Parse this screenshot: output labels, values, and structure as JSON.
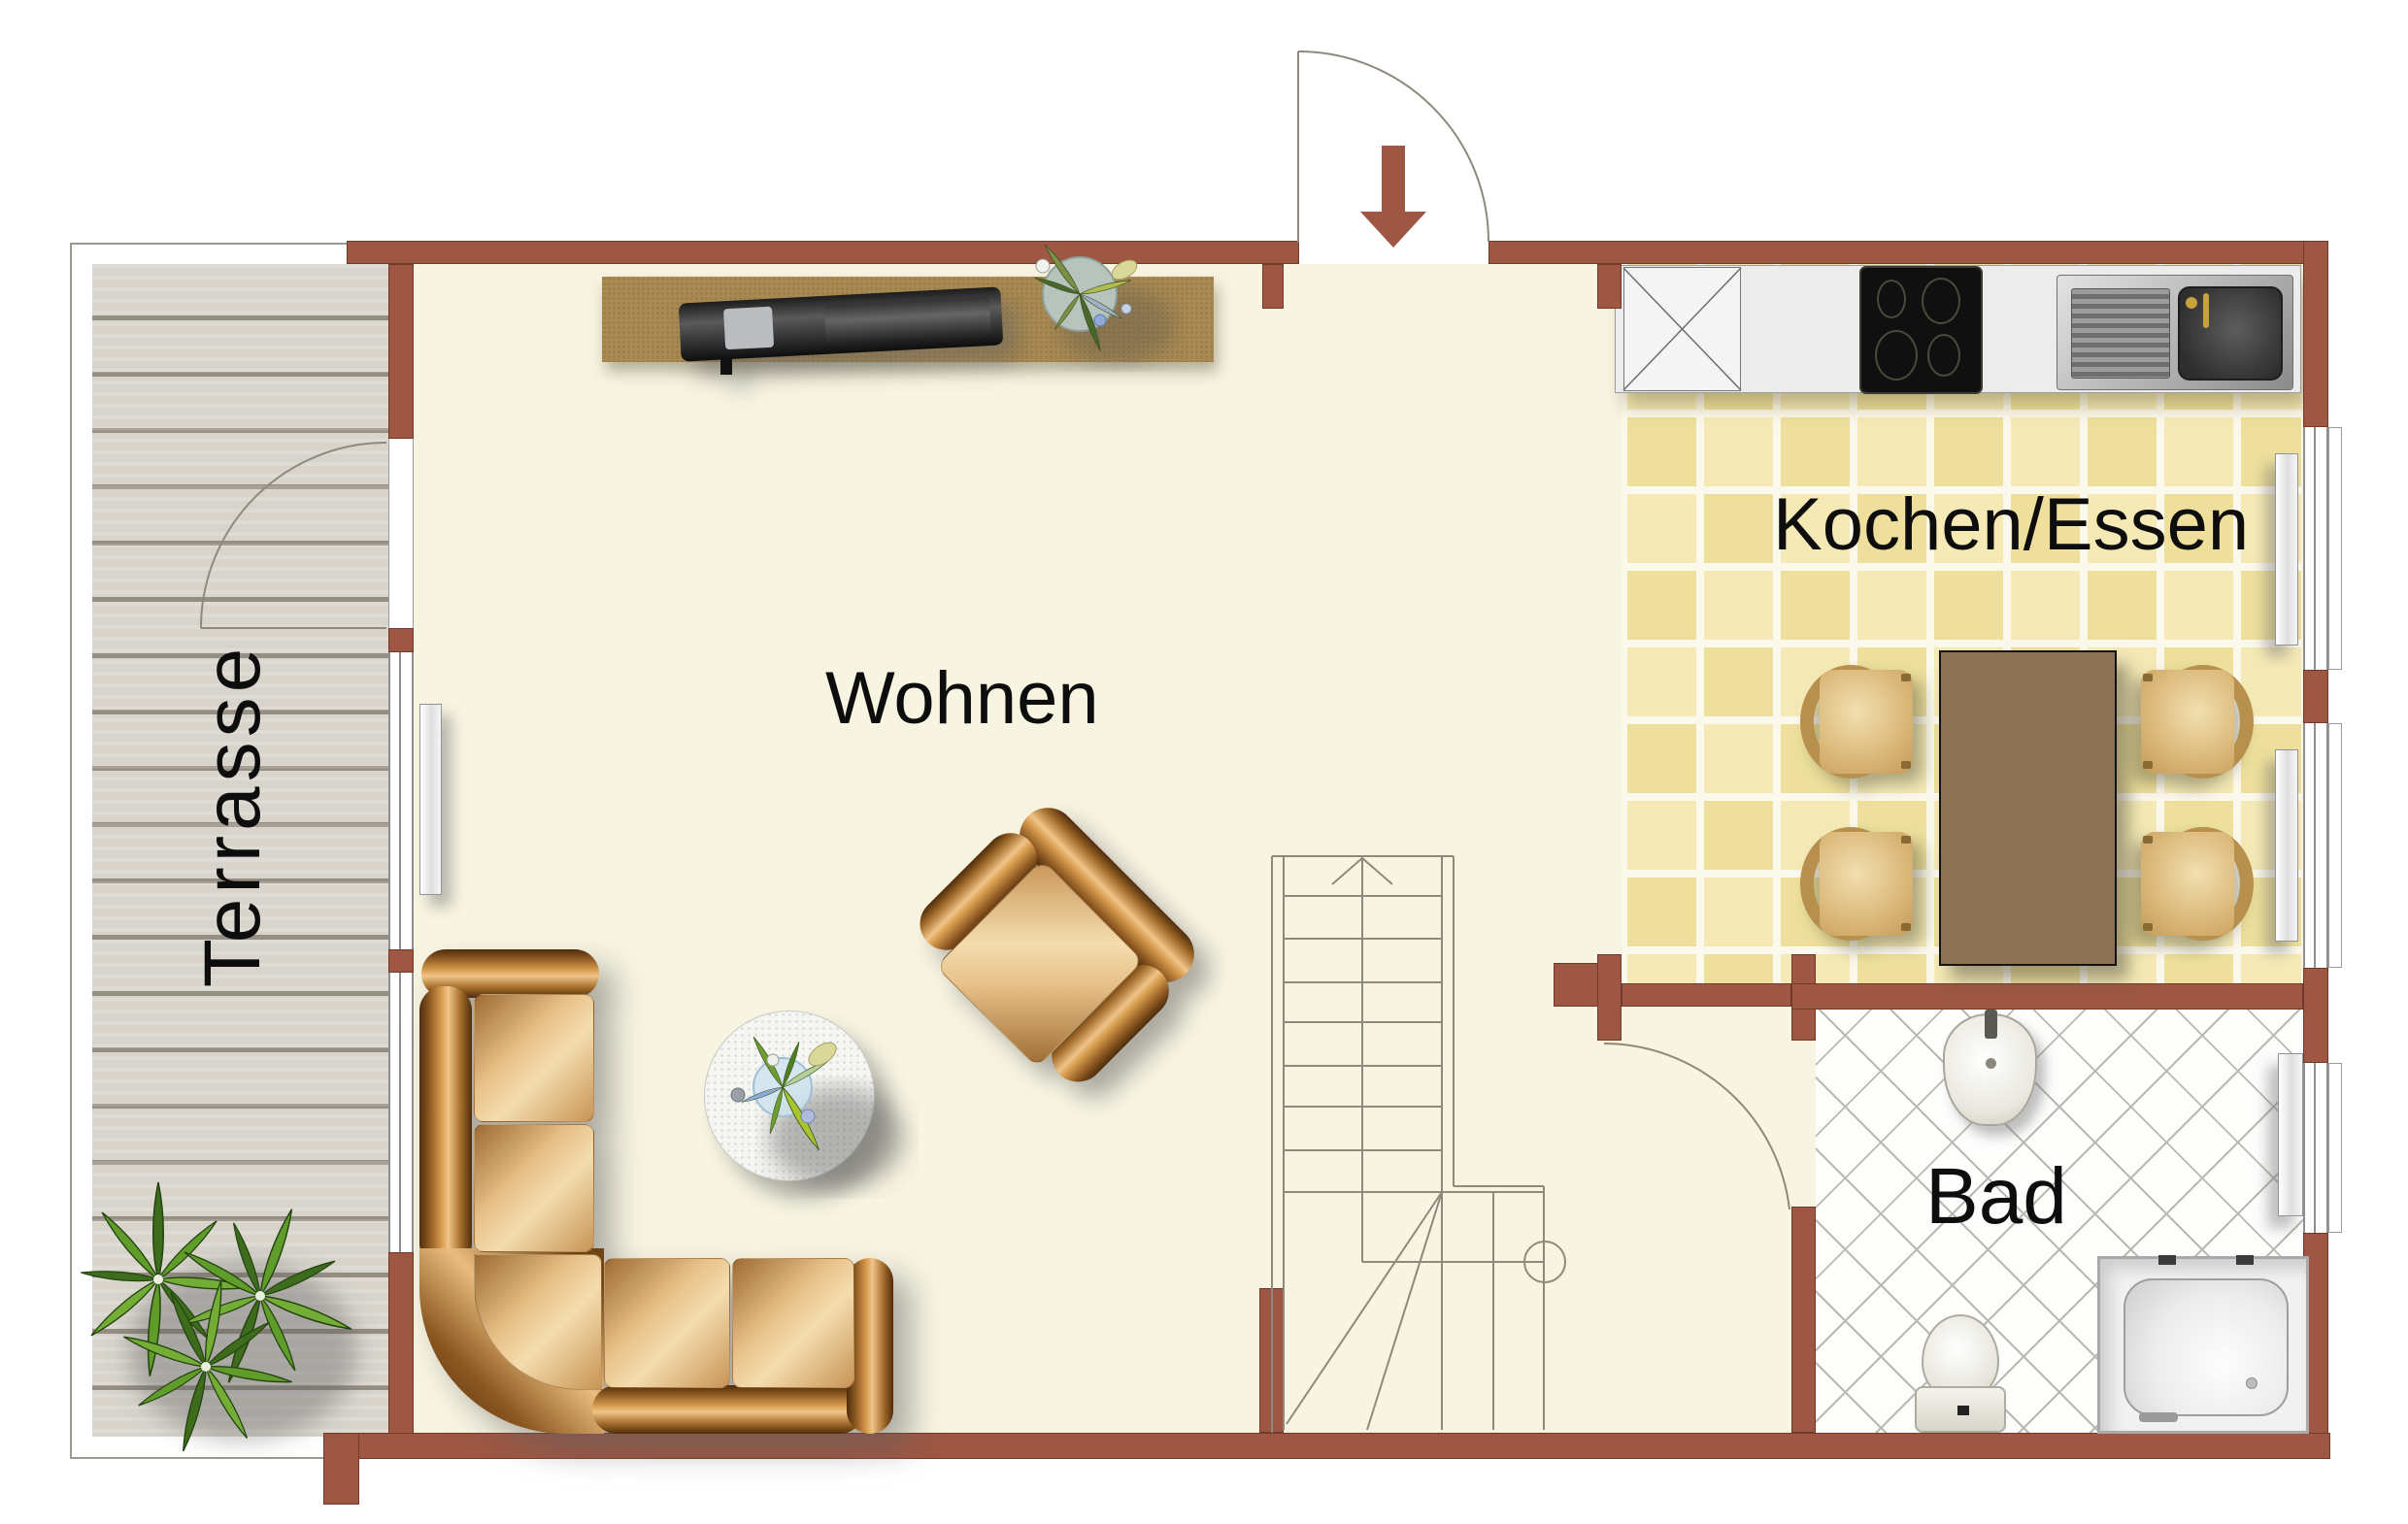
{
  "plan": {
    "type": "apartment-floorplan",
    "rooms": {
      "living": {
        "label": "Wohnen"
      },
      "kitchen": {
        "label": "Kochen/Essen"
      },
      "bath": {
        "label": "Bad"
      },
      "terrace": {
        "label": "Terrasse"
      }
    },
    "entrance": {
      "icon": "entrance-arrow-down"
    },
    "colors": {
      "wall": "#9d5742",
      "floor_living": "#f8f4e2",
      "floor_kitchen_tile": "#f2e6aa",
      "floor_bath": "#fdfdfc",
      "terrace_deck": "#d8d4cc",
      "leather": "#b97b33",
      "dining_table": "#8d7355",
      "label_text": "#0d0d0d"
    },
    "furniture": [
      "corner-sofa",
      "armchair",
      "round-rug",
      "rug-plant",
      "sideboard",
      "tv",
      "sideboard-plant",
      "dining-table",
      "dining-chair",
      "dining-chair",
      "dining-chair",
      "dining-chair",
      "kitchen-counter",
      "dishwasher",
      "cooktop",
      "kitchen-sink",
      "stairs",
      "washbasin",
      "toilet",
      "shower",
      "radiator",
      "radiator",
      "radiator",
      "radiator",
      "terrace-plant"
    ]
  }
}
